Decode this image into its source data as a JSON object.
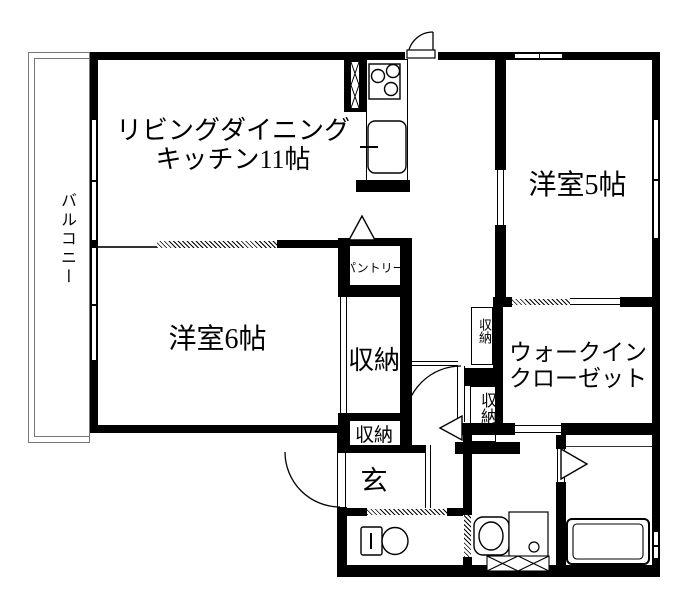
{
  "floorplan": {
    "rooms": {
      "balcony": {
        "label": "バルコニー"
      },
      "ldk": {
        "label_line1": "リビングダイニング",
        "label_line2": "キッチン11帖"
      },
      "western5": {
        "label": "洋室5帖"
      },
      "western6": {
        "label": "洋室6帖"
      },
      "pantry": {
        "label": "パントリー"
      },
      "storage_main": {
        "label": "収納"
      },
      "storage_top": {
        "label": "収納"
      },
      "storage_hall": {
        "label": "収納"
      },
      "storage_lower": {
        "label": "収納"
      },
      "wic": {
        "label_line1": "ウォークイン",
        "label_line2": "クローゼット"
      },
      "entrance": {
        "label": "玄"
      }
    },
    "icons": {
      "stove": "stove-icon",
      "kitchen_sink": "kitchen-sink-icon",
      "toilet": "toilet-icon",
      "washbasin": "washbasin-icon",
      "bathtub": "bathtub-icon",
      "door_arc": "door-arc-icon",
      "fold_door": "fold-door-triangle-icon",
      "duct": "duct-x-icon",
      "louver_window": "louver-x-window-icon"
    },
    "colors": {
      "wall": "#000000",
      "background": "#ffffff",
      "balcony_line": "#777777"
    }
  }
}
